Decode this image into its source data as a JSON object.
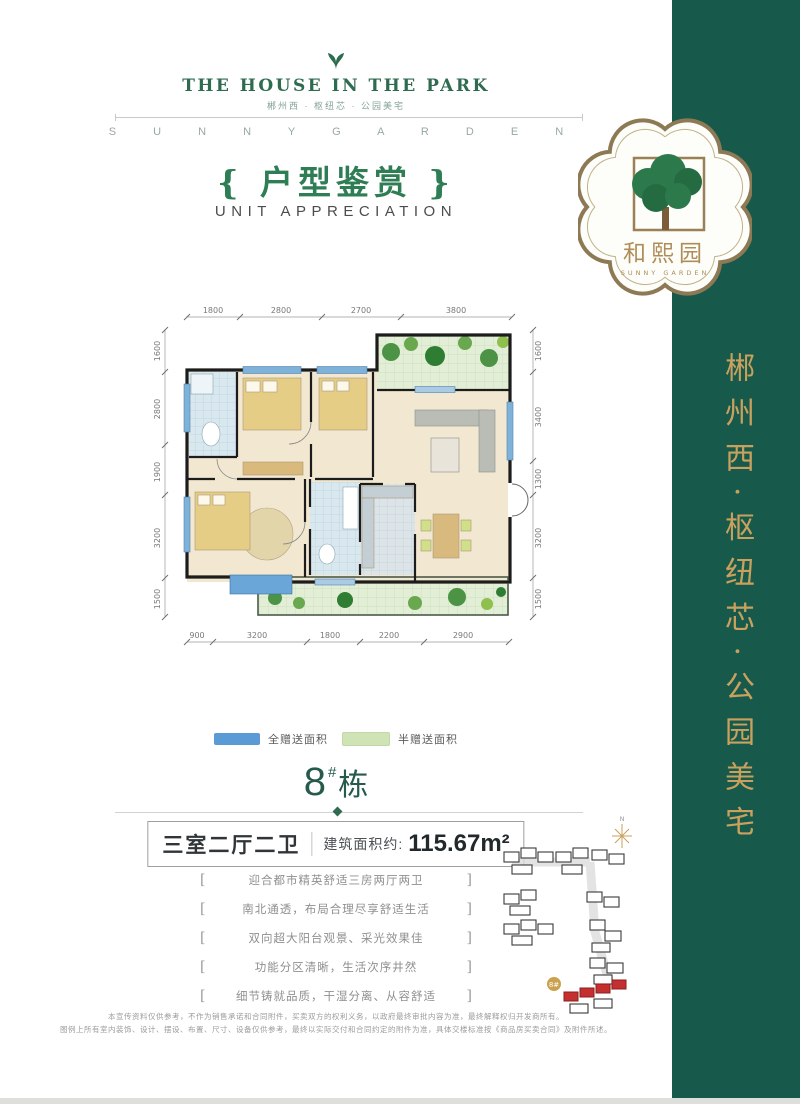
{
  "brand": {
    "title": "THE HOUSE IN THE PARK",
    "tagline": "郴州西 · 枢纽芯 · 公园美宅",
    "banner": "S U N N Y G A R D E N"
  },
  "badge": {
    "name_cn": "和熙园",
    "name_en": "SUNNY GARDEN"
  },
  "sidebar": {
    "vertical_text": "郴州西·枢纽芯·公园美宅",
    "bg_color": "#17594a",
    "text_color": "#c9a15e"
  },
  "section": {
    "title_cn": "{ 户型鉴赏 }",
    "title_en": "UNIT APPRECIATION"
  },
  "floorplan": {
    "dims_top": [
      "1800",
      "2800",
      "2700",
      "3800"
    ],
    "dims_bottom": [
      "900",
      "3200",
      "1800",
      "2200",
      "2900"
    ],
    "dims_left": [
      "1600",
      "2800",
      "1900",
      "3200",
      "1500"
    ],
    "dims_right": [
      "1600",
      "3400",
      "1300",
      "3200",
      "1500"
    ],
    "legend": [
      {
        "label": "全赠送面积",
        "color": "#5b9bd5"
      },
      {
        "label": "半赠送面积",
        "color": "#cfe3b4"
      }
    ]
  },
  "unit": {
    "building": "8",
    "hash": "#",
    "suffix": "栋",
    "layout": "三室二厅二卫",
    "area_label": "建筑面积约:",
    "area_value": "115.67m²"
  },
  "features_bracket": {
    "l": "[",
    "r": "]"
  },
  "features": [
    "迎合都市精英舒适三房两厅两卫",
    "南北通透，布局合理尽享舒适生活",
    "双向超大阳台观景、采光效果佳",
    "功能分区清晰，生活次序井然",
    "细节铸就品质，干湿分离、从容舒适"
  ],
  "siteplan": {
    "compass": "N",
    "label": "8#",
    "highlight_color": "#c43030"
  },
  "disclaimer": [
    "本宣传资料仅供参考，不作为销售承诺和合同附件，买卖双方的权利义务，以政府最终审批内容为准，最终解释权归开发商所有。",
    "图例上所有室内装饰、设计、摆设、布置、尺寸、设备仅供参考，最终以实际交付和合同约定的附件为准，具体交楼标准按《商品房买卖合同》及附件所述。"
  ]
}
